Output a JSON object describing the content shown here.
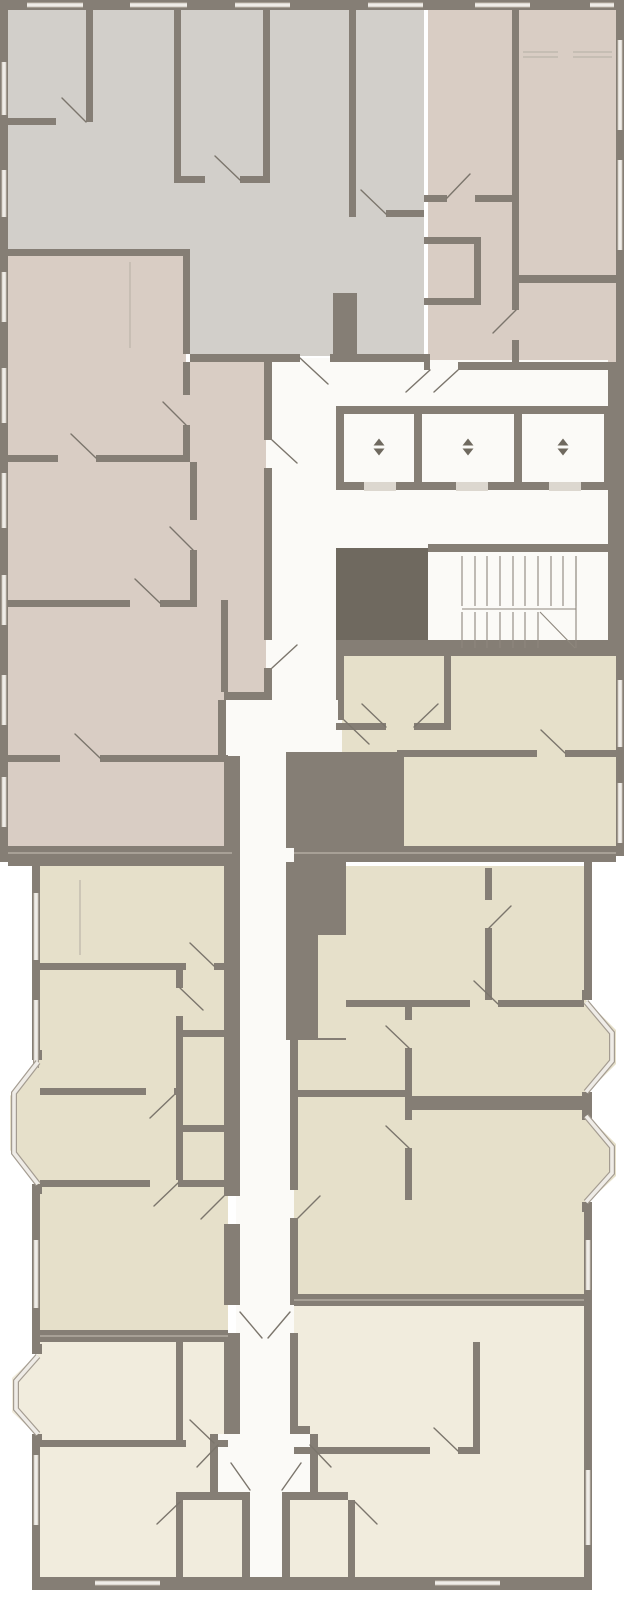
{
  "title": "Residential floor plan",
  "colors": {
    "bg": "#ffffff",
    "wall": "#857e75",
    "wallDark": "#6f695f",
    "gray": "#d2cfca",
    "taupe": "#d9cdc4",
    "beige": "#e6e0ca",
    "cream": "#f1ecdd",
    "corridor": "#fbfaf7",
    "glass": "#efece7",
    "frame": "#a49c91",
    "stair": "#8e877d",
    "door": "#7b756c",
    "thin": "#bcb5aa",
    "sill": "#dcd7cf"
  },
  "icons": {
    "elevator": "up-down-arrows",
    "stairs": "parallel-tread-lines",
    "door": "diagonal-swing-line",
    "window": "triple-line-band"
  },
  "plan": {
    "elevator_count": 3,
    "stair_flight_count": 2,
    "bay_window_count": 4
  }
}
